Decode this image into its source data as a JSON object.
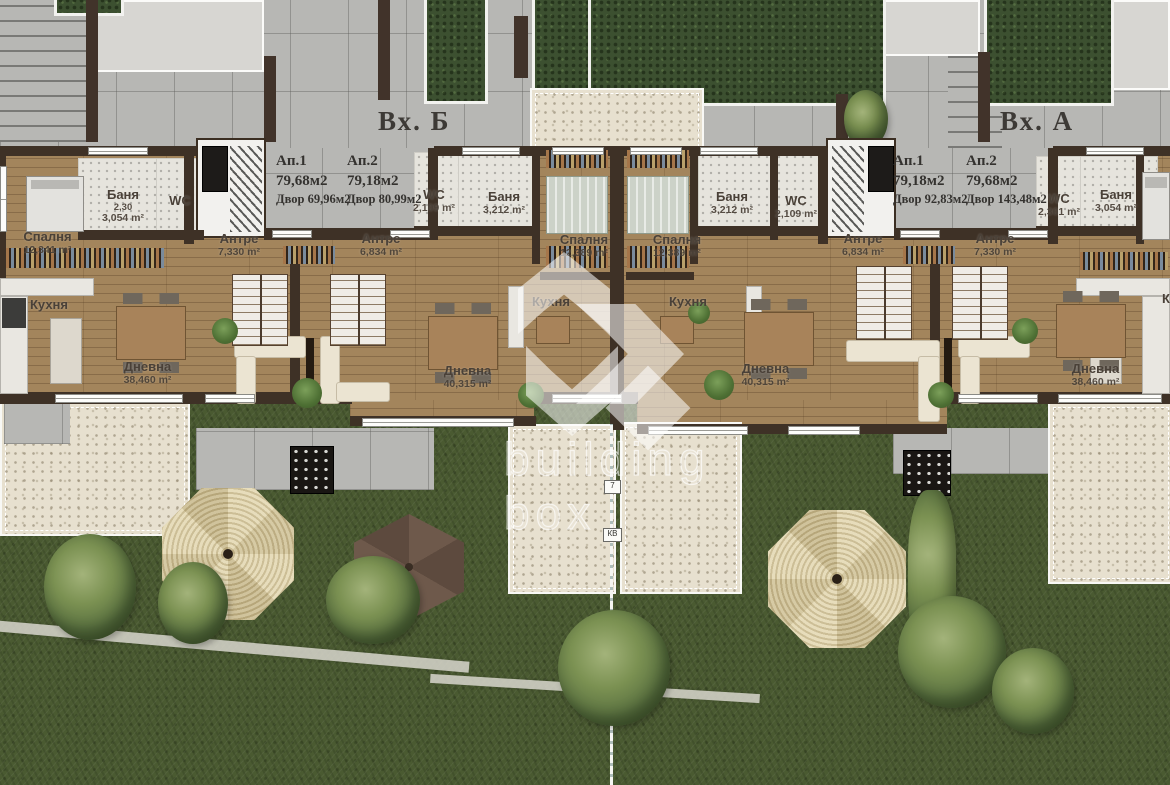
{
  "entrances": {
    "b": {
      "label": "Вх. Б"
    },
    "a": {
      "label": "Вх. А"
    }
  },
  "apartments": {
    "b1": {
      "name": "Ап.1",
      "area": "79,68м2",
      "yard": "Двор 69,96м2"
    },
    "b2": {
      "name": "Ап.2",
      "area": "79,18м2",
      "yard": "Двор 80,99м2"
    },
    "a1": {
      "name": "Ап.1",
      "area": "79,18м2",
      "yard": "Двор 92,83м2"
    },
    "a2": {
      "name": "Ап.2",
      "area": "79,68м2",
      "yard": "Двор 143,48м2"
    }
  },
  "rooms": {
    "b1_bedroom": {
      "name": "Спалня",
      "area": "12,341 m²"
    },
    "b1_bath": {
      "name": "Баня",
      "note": "2,30",
      "area": "3,054 m²"
    },
    "b1_wc": {
      "name": "WC"
    },
    "b1_hall": {
      "name": "Антре",
      "area": "7,330 m²"
    },
    "b1_kitchen": {
      "name": "Кухня"
    },
    "b1_living": {
      "name": "Дневна",
      "area": "38,460 m²"
    },
    "b2_hall": {
      "name": "Антре",
      "area": "6,834 m²"
    },
    "b2_wc": {
      "name": "WC",
      "area": "2,109 m²"
    },
    "b2_bath": {
      "name": "Баня",
      "area": "3,212 m²"
    },
    "b2_bedroom": {
      "name": "Спалня",
      "area": "12,389 m²"
    },
    "b2_kitchen": {
      "name": "Кухня"
    },
    "b2_living": {
      "name": "Дневна",
      "area": "40,315 m²"
    },
    "a1_bedroom": {
      "name": "Спалня",
      "area": "12,389 m²"
    },
    "a1_bath": {
      "name": "Баня",
      "area": "3,212 m²"
    },
    "a1_wc": {
      "name": "WC",
      "area": "2,109 m²"
    },
    "a1_hall": {
      "name": "Антре",
      "area": "6,834 m²"
    },
    "a1_kitchen": {
      "name": "Кухня"
    },
    "a1_living": {
      "name": "Дневна",
      "area": "40,315 m²"
    },
    "a2_hall": {
      "name": "Антре",
      "area": "7,330 m²"
    },
    "a2_wc": {
      "name": "WC",
      "area": "2,301 m²"
    },
    "a2_bath": {
      "name": "Баня",
      "area": "3,054 m²"
    },
    "a2_kitchen": {
      "name": "Кухня"
    },
    "a2_living": {
      "name": "Дневна",
      "area": "38,460 m²"
    }
  },
  "watermark": {
    "line1": "building",
    "line2": "box"
  },
  "markers": {
    "pole_number": "7",
    "pole_label": "КВ"
  },
  "colors": {
    "grass": "#4a5a31",
    "wood": "#a3855c",
    "wall": "#3e3126",
    "tile": "#b7b7b4",
    "gravel": "#e7e0cf",
    "hedge": "#3c5030",
    "gazebo": "#dcd0a8",
    "umbrella": "#64503f",
    "watermark": "#ffffff"
  }
}
